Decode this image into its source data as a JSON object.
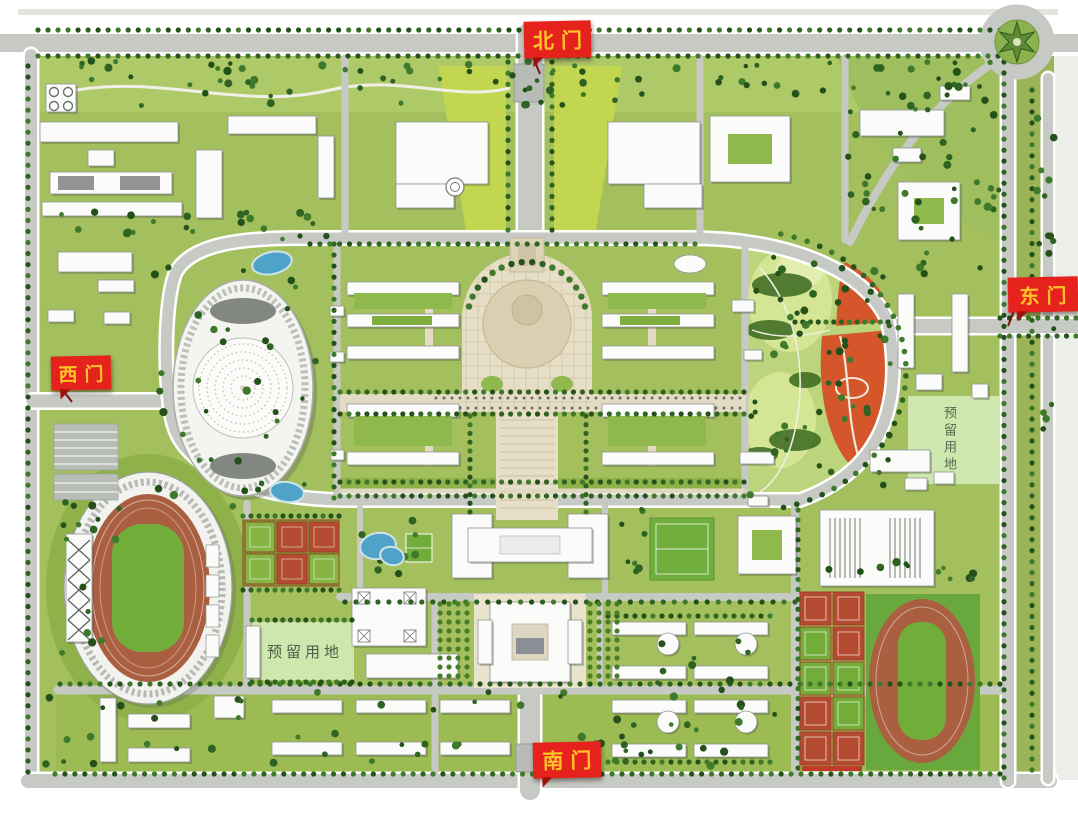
{
  "map": {
    "gates": {
      "north": {
        "label": "北门"
      },
      "east": {
        "label": "东门"
      },
      "west": {
        "label": "西门"
      },
      "south": {
        "label": "南门"
      }
    },
    "reserved_plots": {
      "east": {
        "label": "预留用地"
      },
      "southwest": {
        "label": "预留用地"
      }
    },
    "colors": {
      "gate_banner_bg": "#e5231c",
      "gate_banner_text": "#ffc327",
      "campus_green": "#a4c05e",
      "north_strip_green": "#aec967",
      "bright_lawn": "#c3d64f",
      "park_green": "#bcd47b",
      "hill_light": "#d4e593",
      "tree_dark": "#24511a",
      "flower_field_orange": "#d4562a",
      "running_track": "#ab5f41",
      "sports_field_green": "#72ad3a",
      "court_red": "#b44b30",
      "water_blue": "#4fa3c8",
      "road_gray": "#c7cac4",
      "plaza_beige": "#e6dec6",
      "building_white": "#fbfbfa",
      "reserved_land_green": "#cde7ae",
      "south_lawn_green": "#9cbc53"
    }
  }
}
